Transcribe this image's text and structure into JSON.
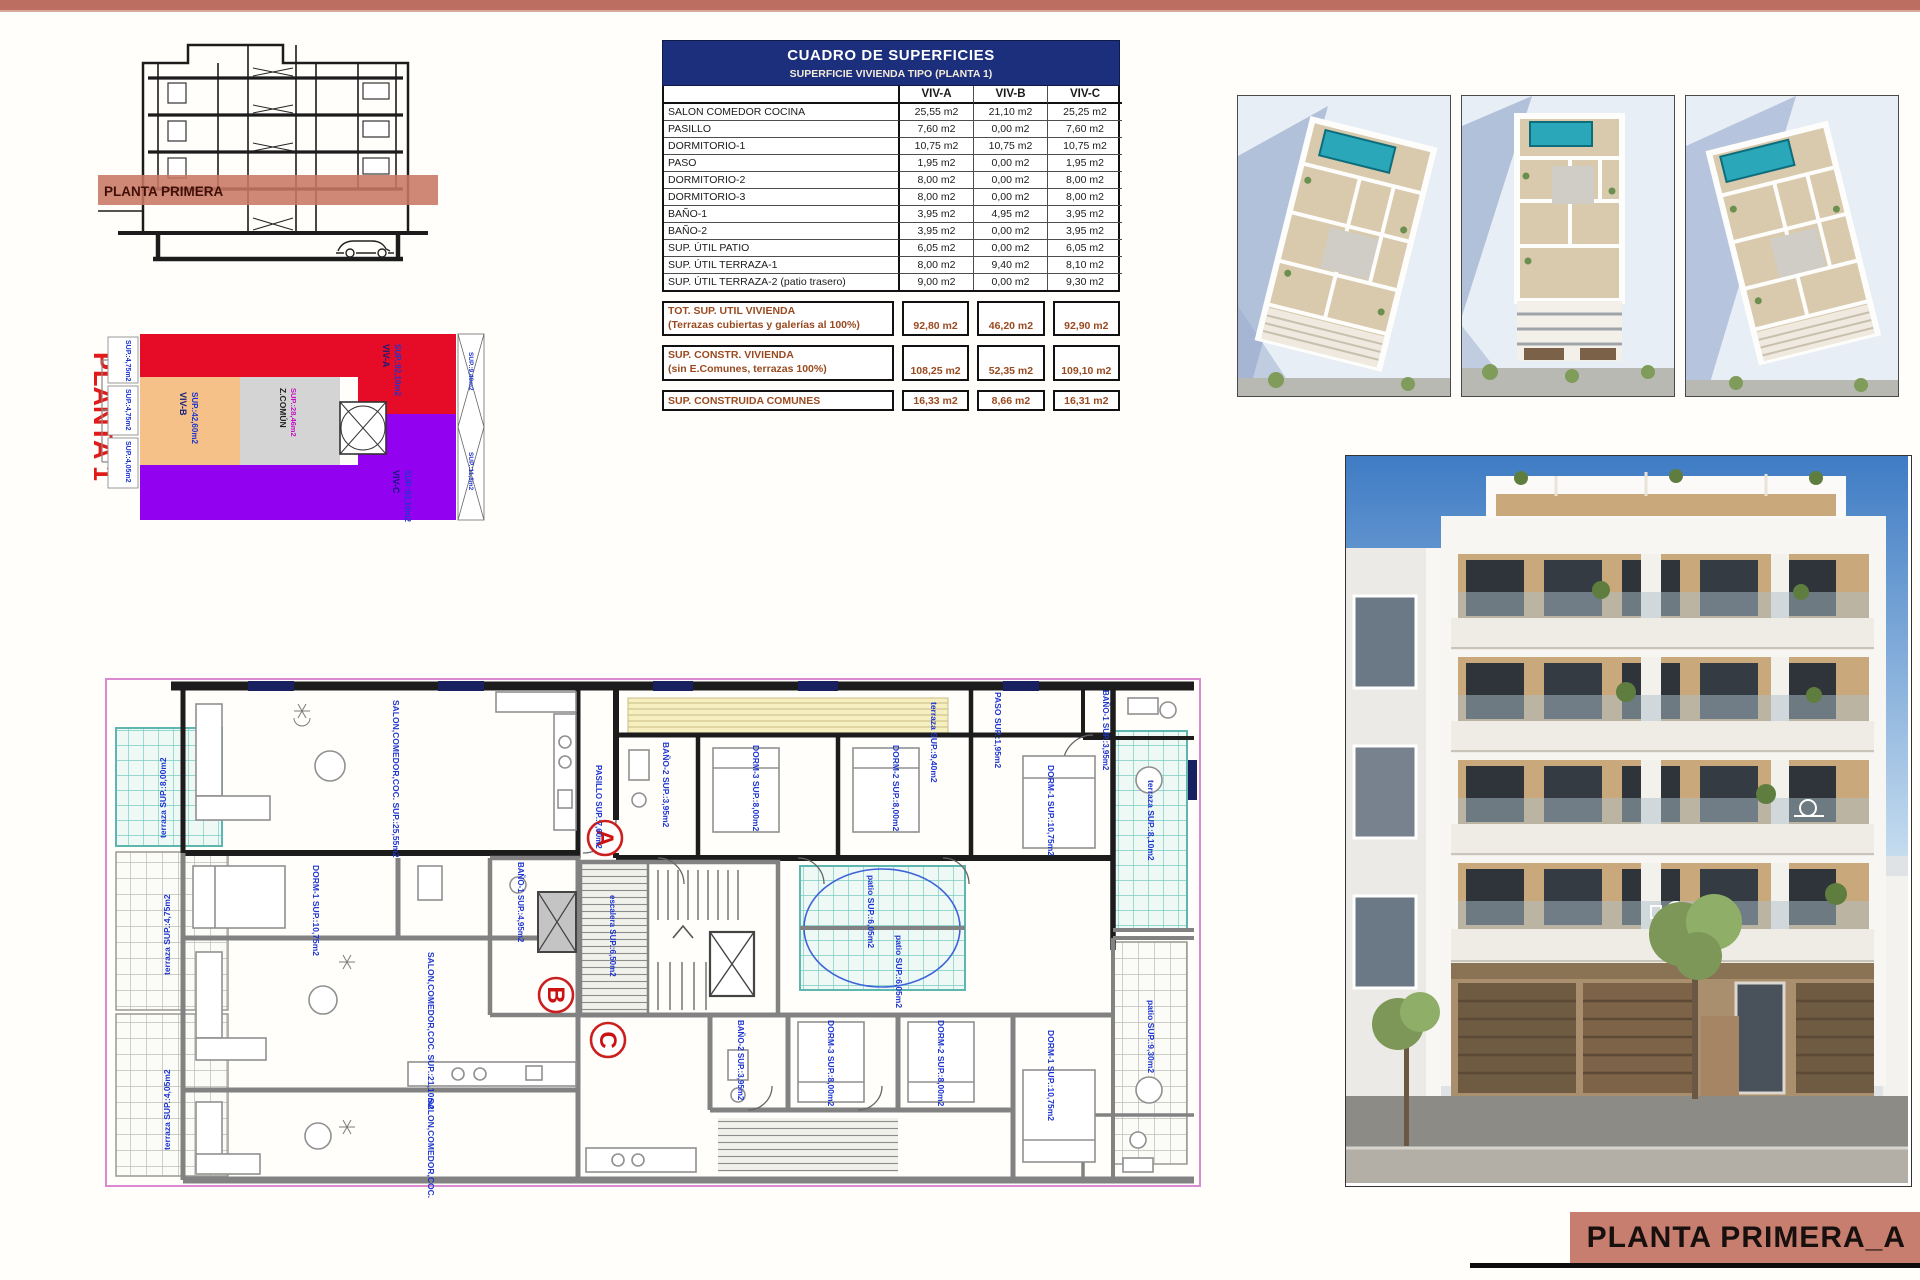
{
  "page": {
    "title_block_label": "PLANTA PRIMERA_A"
  },
  "section_drawing": {
    "band_label": "PLANTA PRIMERA"
  },
  "key_plan": {
    "title": "PLANTA 1",
    "viv_a": {
      "name": "VIV-A",
      "area": "SUP.:92,10m2"
    },
    "viv_b": {
      "name": "VIV-B",
      "area": "SUP.:42,60m2"
    },
    "viv_c": {
      "name": "VIV-C",
      "area": "SUP.:93,10m2"
    },
    "comun": {
      "name": "Z.COMÚN",
      "area": "SUP.:28,46m2"
    },
    "left_labels": [
      "SUP.:4,75m2",
      "SUP.:4,75m2",
      "SUP.:4,05m2"
    ],
    "right_labels": [
      "SUP.:9,40m2",
      "SUP.:11,8m2"
    ]
  },
  "table": {
    "title": "CUADRO DE SUPERFICIES",
    "subtitle": "SUPERFICIE VIVIENDA TIPO  (PLANTA 1)",
    "columns": [
      "VIV-A",
      "VIV-B",
      "VIV-C"
    ],
    "rows": [
      {
        "label": "SALON COMEDOR COCINA",
        "values": [
          "25,55 m2",
          "21,10 m2",
          "25,25 m2"
        ]
      },
      {
        "label": "PASILLO",
        "values": [
          "7,60 m2",
          "0,00 m2",
          "7,60 m2"
        ]
      },
      {
        "label": "DORMITORIO-1",
        "values": [
          "10,75 m2",
          "10,75 m2",
          "10,75 m2"
        ]
      },
      {
        "label": "PASO",
        "values": [
          "1,95 m2",
          "0,00 m2",
          "1,95 m2"
        ]
      },
      {
        "label": "DORMITORIO-2",
        "values": [
          "8,00 m2",
          "0,00 m2",
          "8,00 m2"
        ]
      },
      {
        "label": "DORMITORIO-3",
        "values": [
          "8,00 m2",
          "0,00 m2",
          "8,00 m2"
        ]
      },
      {
        "label": "BAÑO-1",
        "values": [
          "3,95 m2",
          "4,95 m2",
          "3,95 m2"
        ]
      },
      {
        "label": "BAÑO-2",
        "values": [
          "3,95 m2",
          "0,00 m2",
          "3,95 m2"
        ]
      },
      {
        "label": "SUP. ÚTIL PATIO",
        "values": [
          "6,05 m2",
          "0,00 m2",
          "6,05 m2"
        ]
      },
      {
        "label": "SUP. ÚTIL TERRAZA-1",
        "values": [
          "8,00 m2",
          "9,40 m2",
          "8,10 m2"
        ]
      },
      {
        "label": "SUP. ÚTIL TERRAZA-2 (patio trasero)",
        "values": [
          "9,00 m2",
          "0,00 m2",
          "9,30 m2"
        ]
      }
    ],
    "summary": [
      {
        "label": "TOT. SUP. UTIL VIVIENDA",
        "sublabel": "(Terrazas cubiertas y galerías al 100%)",
        "values": [
          "92,80 m2",
          "46,20 m2",
          "92,90 m2"
        ]
      },
      {
        "label": "SUP. CONSTR. VIVIENDA",
        "sublabel": "(sin E.Comunes, terrazas 100%)",
        "values": [
          "108,25 m2",
          "52,35 m2",
          "109,10 m2"
        ]
      },
      {
        "label": "SUP. CONSTRUIDA COMUNES",
        "sublabel": "",
        "values": [
          "16,33 m2",
          "8,66 m2",
          "16,31 m2"
        ]
      }
    ]
  },
  "floor_plan": {
    "markers": [
      "A",
      "B",
      "C"
    ],
    "labels": [
      "SALON,COMEDOR,COC. SUP.:25,55m2",
      "terraza SUP.:9,40m2",
      "terraza SUP.:8,00m2",
      "terraza SUP.:4,75m2",
      "terraza SUP.:4,05m2",
      "BAÑO-2 SUP.:3,95m2",
      "DORM-3 SUP.:8,00m2",
      "DORM-2 SUP.:8,00m2",
      "DORM-1 SUP.:10,75m2",
      "PASO SUP.:1,95m2",
      "BAÑO-1 SUP.:3,95m2",
      "terraza SUP.:8,10m2",
      "patio SUP.:6,05m2",
      "patio SUP.:6,05m2",
      "DORM-1 SUP.:10,75m2",
      "BAÑO-1 SUP.:4,95m2",
      "SALON,COMEDOR,COC. SUP.:21,10m2",
      "SALON,COMEDOR,COC. SUP.:25,25m2",
      "DORM-3 SUP.:8,00m2",
      "DORM-2 SUP.:8,00m2",
      "DORM-1 SUP.:10,75m2",
      "BAÑO-2 SUP.:3,95m2",
      "patio SUP.:9,30m2",
      "escalera SUP.:6,50m2",
      "PASILLO SUP.:7,60m2"
    ]
  }
}
